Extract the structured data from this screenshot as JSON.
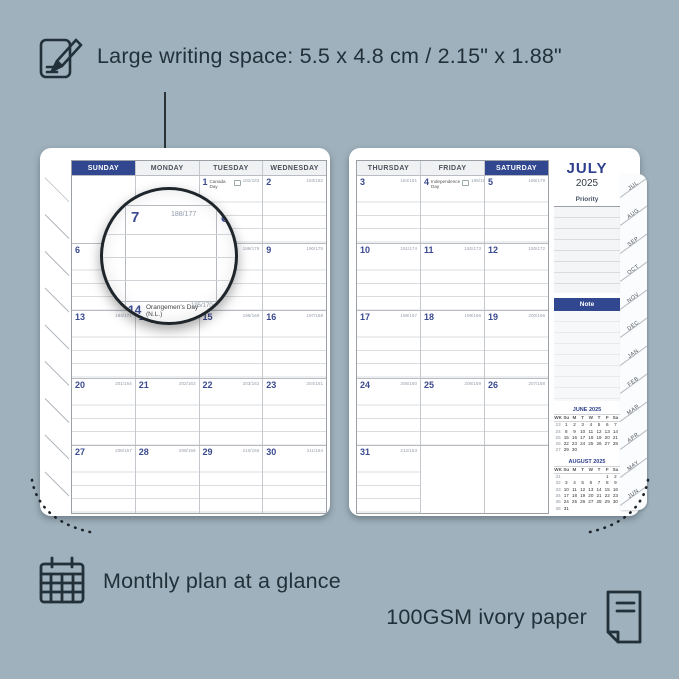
{
  "annotations": {
    "writing_space": "Large writing space: 5.5 x 4.8 cm / 2.15\" x 1.88\"",
    "monthly_plan": "Monthly plan at a glance",
    "paper": "100GSM ivory paper"
  },
  "colors": {
    "background": "#9fb1bc",
    "navy": "#31478f",
    "ink": "#22303a"
  },
  "calendar": {
    "left": {
      "headers": [
        {
          "label": "SUNDAY",
          "highlight": true
        },
        {
          "label": "MONDAY"
        },
        {
          "label": "TUESDAY"
        },
        {
          "label": "WEDNESDAY"
        }
      ],
      "rows": [
        [
          null,
          null,
          {
            "day": "1",
            "counter": "182/183",
            "holiday": "Canada Day"
          },
          {
            "day": "2",
            "counter": "183/182"
          }
        ],
        [
          {
            "day": "6",
            "counter": "187/178"
          },
          {
            "day": "7",
            "counter": "188/177"
          },
          {
            "day": "8",
            "counter": "189/176"
          },
          {
            "day": "9",
            "counter": "190/175"
          }
        ],
        [
          {
            "day": "13",
            "counter": "194/171"
          },
          {
            "day": "14",
            "counter": "195/170",
            "holiday": "Orangemen's Day (N.L.)"
          },
          {
            "day": "15",
            "counter": "196/169"
          },
          {
            "day": "16",
            "counter": "197/168"
          }
        ],
        [
          {
            "day": "20",
            "counter": "201/164"
          },
          {
            "day": "21",
            "counter": "202/163"
          },
          {
            "day": "22",
            "counter": "203/162"
          },
          {
            "day": "23",
            "counter": "204/161"
          }
        ],
        [
          {
            "day": "27",
            "counter": "208/157"
          },
          {
            "day": "28",
            "counter": "209/156"
          },
          {
            "day": "29",
            "counter": "210/155"
          },
          {
            "day": "30",
            "counter": "211/154"
          }
        ]
      ]
    },
    "right": {
      "headers": [
        {
          "label": "THURSDAY"
        },
        {
          "label": "FRIDAY"
        },
        {
          "label": "SATURDAY",
          "highlight": true
        }
      ],
      "rows": [
        [
          {
            "day": "3",
            "counter": "184/181"
          },
          {
            "day": "4",
            "counter": "185/180",
            "holiday": "Independence Day"
          },
          {
            "day": "5",
            "counter": "186/179"
          }
        ],
        [
          {
            "day": "10",
            "counter": "191/174"
          },
          {
            "day": "11",
            "counter": "192/173"
          },
          {
            "day": "12",
            "counter": "193/172"
          }
        ],
        [
          {
            "day": "17",
            "counter": "198/167"
          },
          {
            "day": "18",
            "counter": "199/166"
          },
          {
            "day": "19",
            "200/165": "",
            "counter": "200/165"
          }
        ],
        [
          {
            "day": "24",
            "counter": "205/160"
          },
          {
            "day": "25",
            "counter": "206/159"
          },
          {
            "day": "26",
            "counter": "207/158"
          }
        ],
        [
          {
            "day": "31",
            "counter": "212/153"
          },
          null,
          null
        ]
      ]
    }
  },
  "sidebar": {
    "month": "JULY",
    "year": "2025",
    "priority_label": "Priority",
    "note_label": "Note",
    "mini_calendars": [
      {
        "title": "JUNE 2025",
        "dow": [
          "WK",
          "Su",
          "M",
          "T",
          "W",
          "T",
          "F",
          "Sa"
        ],
        "rows": [
          [
            "23",
            "1",
            "2",
            "3",
            "4",
            "5",
            "6",
            "7"
          ],
          [
            "24",
            "8",
            "9",
            "10",
            "11",
            "12",
            "13",
            "14"
          ],
          [
            "25",
            "15",
            "16",
            "17",
            "18",
            "19",
            "20",
            "21"
          ],
          [
            "26",
            "22",
            "23",
            "24",
            "25",
            "26",
            "27",
            "28"
          ],
          [
            "27",
            "29",
            "30",
            "",
            "",
            "",
            "",
            ""
          ]
        ]
      },
      {
        "title": "AUGUST 2025",
        "dow": [
          "WK",
          "Su",
          "M",
          "T",
          "W",
          "T",
          "F",
          "Sa"
        ],
        "rows": [
          [
            "31",
            "",
            "",
            "",
            "",
            "",
            "1",
            "2"
          ],
          [
            "32",
            "3",
            "4",
            "5",
            "6",
            "7",
            "8",
            "9"
          ],
          [
            "33",
            "10",
            "11",
            "12",
            "13",
            "14",
            "15",
            "16"
          ],
          [
            "34",
            "17",
            "18",
            "19",
            "20",
            "21",
            "22",
            "23"
          ],
          [
            "35",
            "24",
            "25",
            "26",
            "27",
            "28",
            "29",
            "30"
          ],
          [
            "36",
            "31",
            "",
            "",
            "",
            "",
            "",
            ""
          ]
        ]
      }
    ]
  },
  "tabs": [
    "JUL",
    "AUG",
    "SEP",
    "OCT",
    "NOV",
    "DEC",
    "JAN",
    "FEB",
    "MAR",
    "APR",
    "MAY",
    "JUN"
  ],
  "magnifier": {
    "day": "7",
    "counter": "188/177",
    "adjacent_day": "8",
    "bottom_day": "14",
    "bottom_holiday": "Orangemen's Day",
    "bottom_region": "(N.L.)",
    "bottom_counter": "195/170"
  }
}
